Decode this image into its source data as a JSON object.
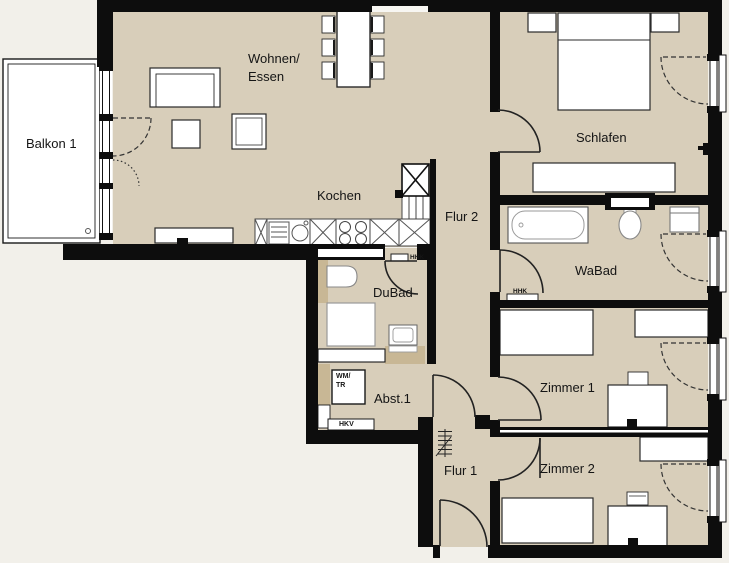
{
  "plan_title": "apartment-floor-plan",
  "rooms": {
    "balkon": "Balkon 1",
    "wohnen_line1": "Wohnen/",
    "wohnen_line2": "Essen",
    "kochen": "Kochen",
    "flur2": "Flur 2",
    "schlafen": "Schlafen",
    "wabad": "WaBad",
    "dubad": "DuBad",
    "abst": "Abst.1",
    "flur1": "Flur 1",
    "zimmer1": "Zimmer 1",
    "zimmer2": "Zimmer 2"
  },
  "annotations": {
    "wm": "WM/",
    "tr": "TR",
    "hkv": "HKV",
    "hhk_dubad": "HHK",
    "hhk_wabad": "HHK"
  },
  "colors": {
    "outside": "#f2f0ea",
    "floor": "#d8ceba",
    "partition_wall": "#c8b795",
    "load_wall": "#0d0d0d",
    "fixture_fill": "#ffffff"
  }
}
